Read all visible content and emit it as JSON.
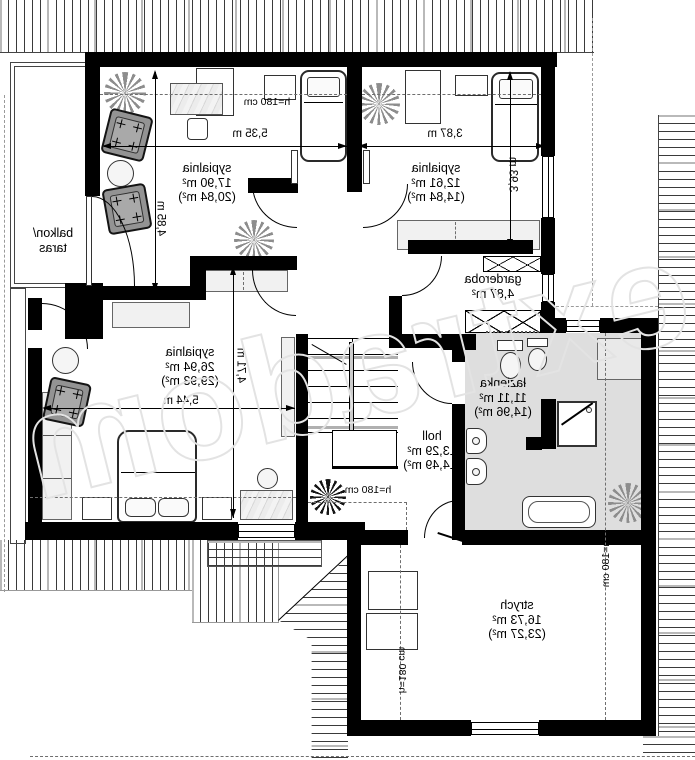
{
  "plan": {
    "watermark": "extradom",
    "rooms": {
      "bedroom_top_left": {
        "name": "sypialnia",
        "area": "17,90 m²",
        "area_gross": "(20,84 m²)"
      },
      "bedroom_top_right": {
        "name": "sypialnia",
        "area": "12,61 m²",
        "area_gross": "(14,84 m²)"
      },
      "bedroom_master": {
        "name": "sypialnia",
        "area": "26,94 m²",
        "area_gross": "(29,93 m²)"
      },
      "balcony": {
        "line1": "balkon/",
        "line2": "taras"
      },
      "garderoba": {
        "name": "garderoba",
        "area": "4,87 m²"
      },
      "hall": {
        "name": "holl",
        "area": "13,29 m²",
        "area_gross": "(14,49 m²)"
      },
      "bathroom": {
        "name": "łazienka",
        "area": "11,11 m²",
        "area_gross": "(14,96 m²)"
      },
      "attic": {
        "name": "strych",
        "area": "16,73 m²",
        "area_gross": "(23,27 m²)"
      }
    },
    "dimensions": {
      "bedroom_top_left_w": "5,35 m",
      "bedroom_top_left_h": "4,85 m",
      "bedroom_top_right_w": "3,87 m",
      "bedroom_top_right_h": "3,93 m",
      "bedroom_master_w": "5,44 m",
      "bedroom_master_h": "4,71 m"
    },
    "clearance": {
      "bedroom_top_left": "h=180 cm",
      "hall": "h=180 cm",
      "attic_left": "h=180 cm",
      "attic_right": "h=180 cm"
    },
    "colors": {
      "wall": "#000000",
      "bathroom_floor": "#dedede",
      "furniture_light": "#f1f1f1",
      "furniture_dark": "#939393",
      "watermark_outline": "#e3e3e3"
    }
  }
}
